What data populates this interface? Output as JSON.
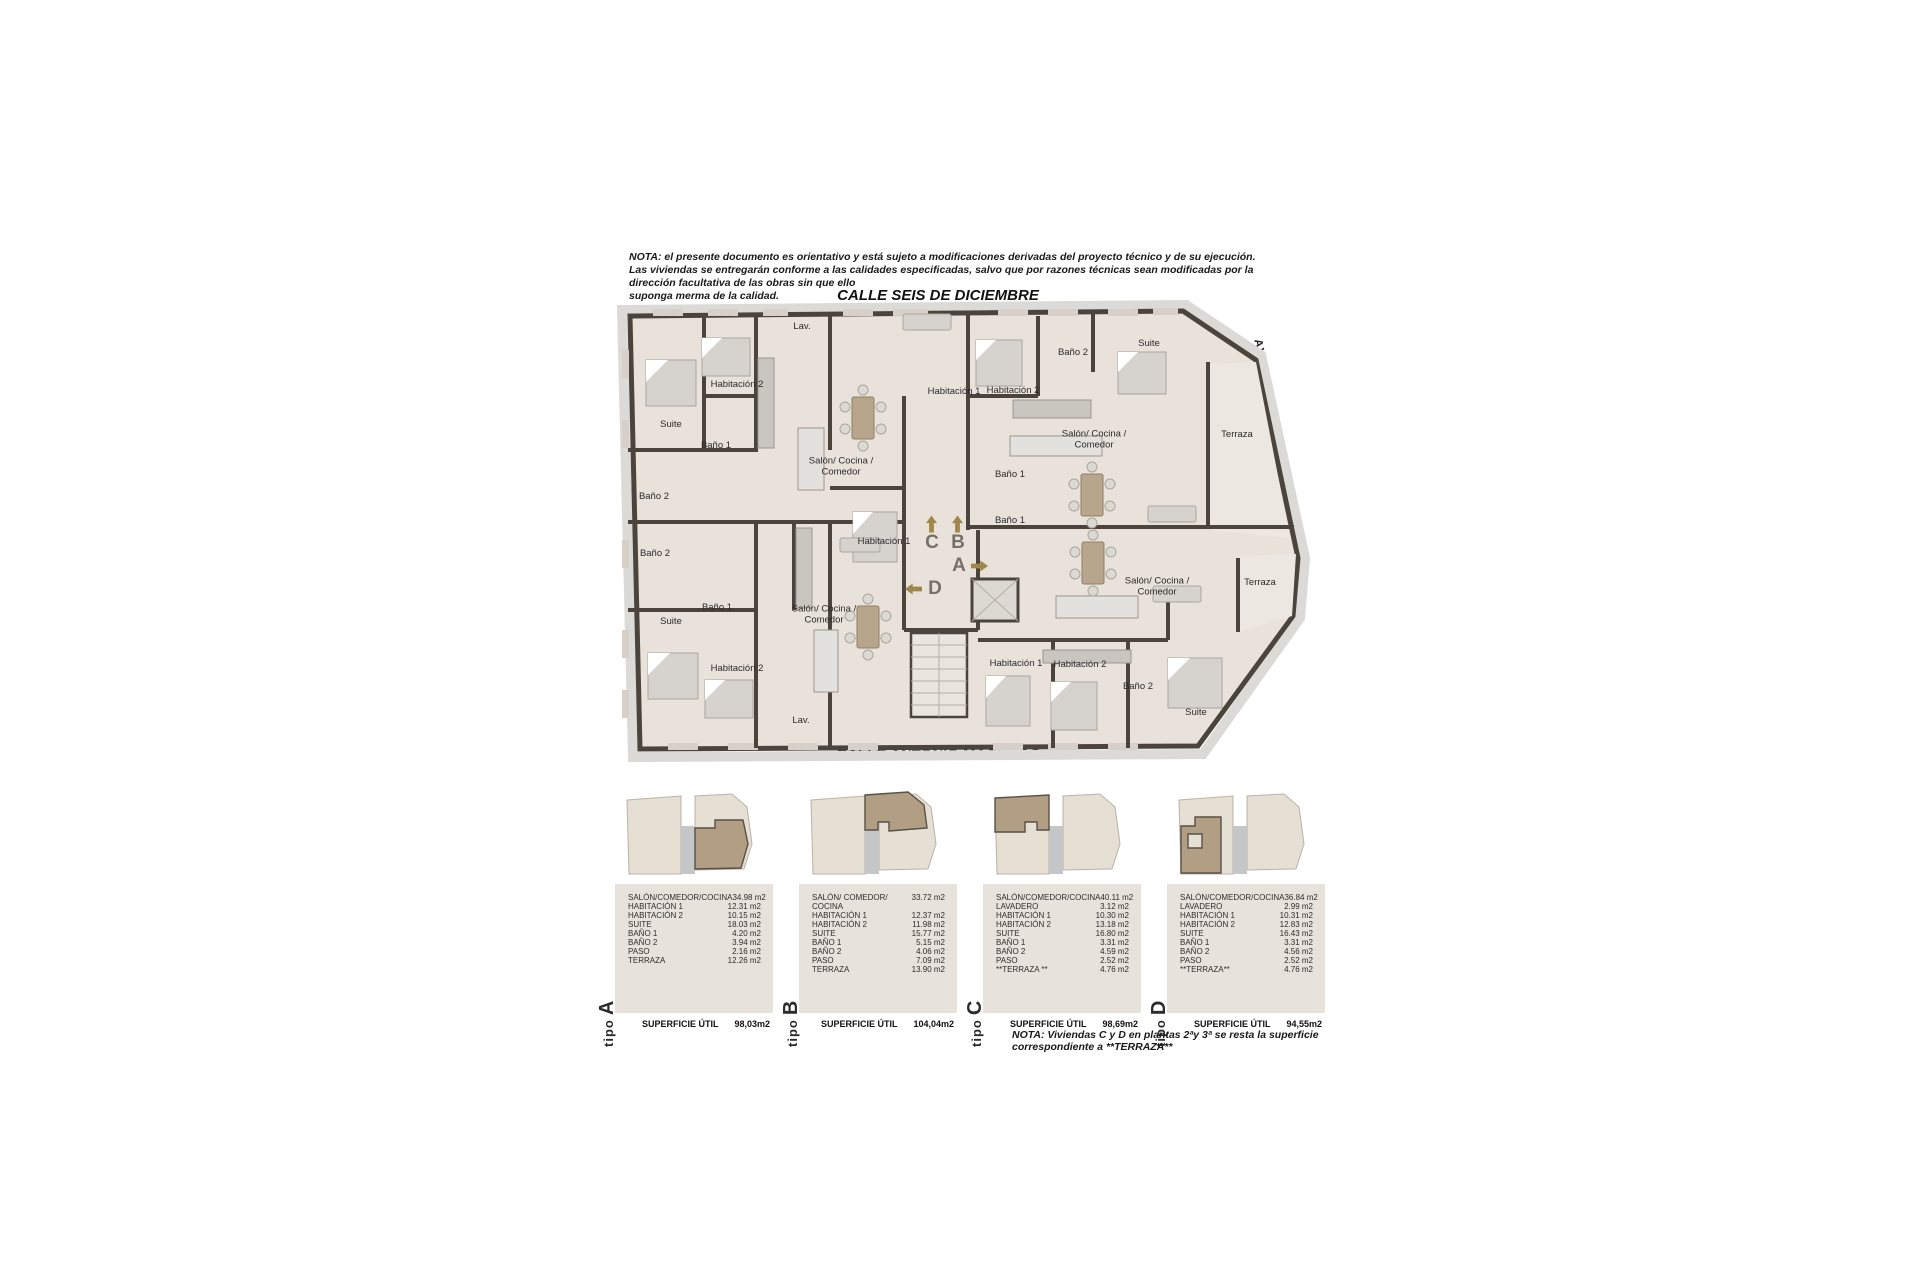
{
  "note_top": "NOTA:  el presente documento es orientativo y está sujeto a modificaciones derivadas del proyecto técnico y de su ejecución.\nLas viviendas se entregarán conforme a las calidades especificadas, salvo que por razones técnicas sean modificadas por la dirección facultativa de las obras sin que ello\nsuponga merma de la calidad.",
  "streets": {
    "top": "CALLE SEIS DE DICIEMBRE",
    "bottom": "CALLE ANTONIO MACHADO",
    "right": "AVENIDA DE LA LIBERTAD"
  },
  "plan": {
    "rooms": [
      {
        "label": "Lav.",
        "x": 194,
        "y": 27
      },
      {
        "label": "Habitación 2",
        "x": 129,
        "y": 85
      },
      {
        "label": "Habitación 1",
        "x": 346,
        "y": 92
      },
      {
        "label": "Habitación 2",
        "x": 405,
        "y": 91
      },
      {
        "label": "Baño 2",
        "x": 465,
        "y": 53
      },
      {
        "label": "Suite",
        "x": 541,
        "y": 44
      },
      {
        "label": "Suite",
        "x": 63,
        "y": 125
      },
      {
        "label": "Baño 1",
        "x": 108,
        "y": 146
      },
      {
        "label": "Salón/ Cocina /\nComedor",
        "x": 233,
        "y": 167
      },
      {
        "label": "Salón/ Cocina /\nComedor",
        "x": 486,
        "y": 140
      },
      {
        "label": "Terraza",
        "x": 629,
        "y": 135
      },
      {
        "label": "Baño 2",
        "x": 46,
        "y": 197
      },
      {
        "label": "Baño 2",
        "x": 47,
        "y": 254
      },
      {
        "label": "Habitación 1",
        "x": 276,
        "y": 242
      },
      {
        "label": "Baño 1",
        "x": 402,
        "y": 175
      },
      {
        "label": "Baño 1",
        "x": 402,
        "y": 221
      },
      {
        "label": "Salón/ Cocina /\nComedor",
        "x": 549,
        "y": 287
      },
      {
        "label": "Terraza",
        "x": 652,
        "y": 283
      },
      {
        "label": "Baño 1",
        "x": 109,
        "y": 308
      },
      {
        "label": "Suite",
        "x": 63,
        "y": 322
      },
      {
        "label": "Salón/ Cocina /\nComedor",
        "x": 216,
        "y": 315
      },
      {
        "label": "Habitación 2",
        "x": 129,
        "y": 369
      },
      {
        "label": "Lav.",
        "x": 193,
        "y": 421
      },
      {
        "label": "Habitación 1",
        "x": 408,
        "y": 364
      },
      {
        "label": "Habitación 2",
        "x": 472,
        "y": 365
      },
      {
        "label": "Baño 2",
        "x": 530,
        "y": 387
      },
      {
        "label": "Suite",
        "x": 588,
        "y": 413
      }
    ],
    "entrances": [
      {
        "letter": "C",
        "x": 324,
        "y": 243,
        "dir": "up"
      },
      {
        "letter": "B",
        "x": 350,
        "y": 243,
        "dir": "up"
      },
      {
        "letter": "A",
        "x": 351,
        "y": 266,
        "dir": "right"
      },
      {
        "letter": "D",
        "x": 327,
        "y": 289,
        "dir": "left"
      }
    ]
  },
  "labels": {
    "tipo_word": "tipo",
    "superficie": "SUPERFICIE ÚTIL"
  },
  "units": [
    {
      "letter": "A",
      "rows": [
        [
          "SALÓN/COMEDOR/COCINA",
          "34.98 m2"
        ],
        [
          "HABITACIÓN 1",
          "12.31 m2"
        ],
        [
          "HABITACIÓN 2",
          "10.15 m2"
        ],
        [
          "SUITE",
          "18.03 m2"
        ],
        [
          "BAÑO 1",
          "4.20 m2"
        ],
        [
          "BAÑO 2",
          "3.94 m2"
        ],
        [
          "PASO",
          "2.16 m2"
        ],
        [
          "TERRAZA",
          "12.26 m2"
        ]
      ],
      "superficie": "98,03m2"
    },
    {
      "letter": "B",
      "rows": [
        [
          "SALÓN/ COMEDOR/ COCINA",
          "33.72 m2"
        ],
        [
          "HABITACIÓN 1",
          "12.37 m2"
        ],
        [
          "HABITACIÓN 2",
          "11.98 m2"
        ],
        [
          "SUITE",
          "15.77 m2"
        ],
        [
          "BAÑO 1",
          "5.15 m2"
        ],
        [
          "BAÑO 2",
          "4.06 m2"
        ],
        [
          "PASO",
          "7.09 m2"
        ],
        [
          "TERRAZA",
          "13.90 m2"
        ]
      ],
      "superficie": "104,04m2"
    },
    {
      "letter": "C",
      "rows": [
        [
          "SALÓN/COMEDOR/COCINA",
          "40.11 m2"
        ],
        [
          "LAVADERO",
          "3.12 m2"
        ],
        [
          "HABITACIÓN 1",
          "10.30 m2"
        ],
        [
          "HABITACIÓN 2",
          "13.18 m2"
        ],
        [
          "SUITE",
          "16.80 m2"
        ],
        [
          "BAÑO 1",
          "3.31 m2"
        ],
        [
          "BAÑO 2",
          "4.59 m2"
        ],
        [
          "PASO",
          "2.52 m2"
        ],
        [
          "**TERRAZA **",
          "4.76 m2"
        ]
      ],
      "superficie": "98,69m2"
    },
    {
      "letter": "D",
      "rows": [
        [
          "SALÓN/COMEDOR/COCINA",
          "36.84 m2"
        ],
        [
          "LAVADERO",
          "2.99 m2"
        ],
        [
          "HABITACIÓN 1",
          "10.31 m2"
        ],
        [
          "HABITACIÓN 2",
          "12.83 m2"
        ],
        [
          "SUITE",
          "16.43 m2"
        ],
        [
          "BAÑO 1",
          "3.31 m2"
        ],
        [
          "BAÑO 2",
          "4.56 m2"
        ],
        [
          "PASO",
          "2.52 m2"
        ],
        [
          "**TERRAZA**",
          "4.76 m2"
        ]
      ],
      "superficie": "94,55m2"
    }
  ],
  "note_bottom": "NOTA: Viviendas C y D en plantas 2ªy 3ª se resta la superficie correspondiente a **TERRAZA**",
  "colors": {
    "wall": "#4b443d",
    "floor": "#e8e2da",
    "sidewalk": "#dcdad6",
    "furniture": "#d6d3cf",
    "table_bg": "#e7e2db",
    "arrow": "#a08648",
    "minimap_base": "#e6dfd3",
    "minimap_highlight": "#b29e82",
    "minimap_core": "#c4c6c8",
    "text": "#1f1f1f"
  }
}
